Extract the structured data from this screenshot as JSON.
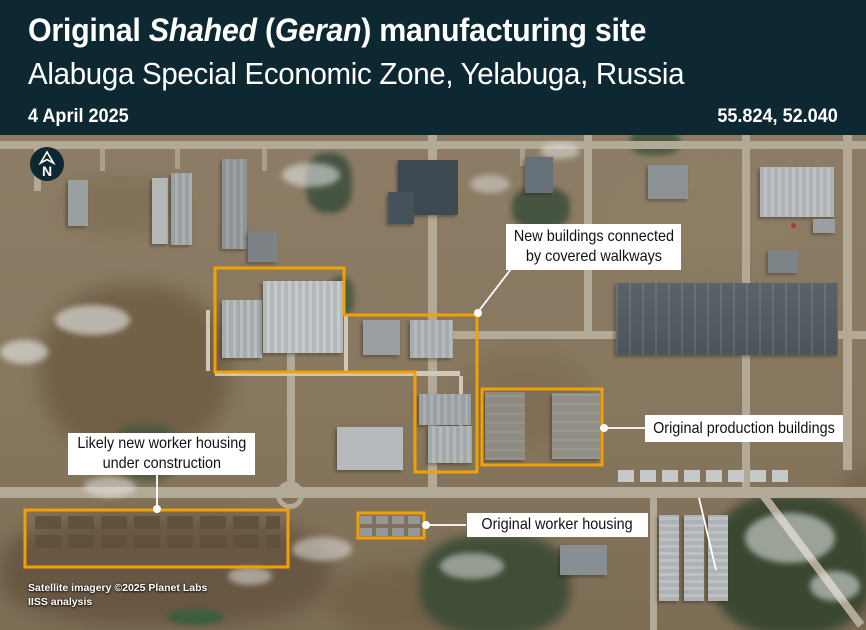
{
  "header": {
    "title": {
      "prefix": "Original ",
      "name1": "Shahed",
      "mid": " (",
      "name2": "Geran",
      "suffix": ") manufacturing site"
    },
    "subtitle": "Alabuga Special Economic Zone, Yelabuga, Russia",
    "date": "4 April 2025",
    "coordinates": "55.824, 52.040",
    "background_color": "#0E2832"
  },
  "map": {
    "north_indicator": "N",
    "annotation_outline_color": "#F2A105",
    "leader_line_color": "#FFFFFF",
    "annotations": {
      "new_buildings": {
        "line1": "New buildings connected",
        "line2": "by covered walkways"
      },
      "production_buildings": {
        "label": "Original production buildings"
      },
      "new_worker_housing": {
        "line1": "Likely new worker housing",
        "line2": "under construction"
      },
      "worker_housing": {
        "label": "Original worker housing"
      }
    },
    "credits": {
      "line1": "Satellite imagery ©2025 Planet Labs",
      "line2": "IISS analysis"
    }
  }
}
